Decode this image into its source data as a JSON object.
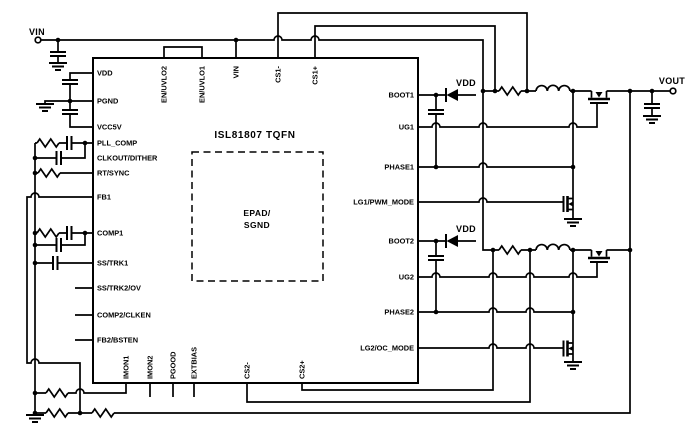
{
  "chip": {
    "title": "ISL81807 TQFN",
    "epad_line1": "EPAD/",
    "epad_line2": "SGND"
  },
  "pins": {
    "left": [
      "VDD",
      "PGND",
      "VCC5V",
      "PLL_COMP",
      "CLKOUT/DITHER",
      "RT/SYNC",
      "FB1",
      "COMP1",
      "SS/TRK1",
      "SS/TRK2/OV",
      "COMP2/CLKEN",
      "FB2/BSTEN"
    ],
    "top": [
      "EN/UVLO2",
      "EN/UVLO1",
      "VIN",
      "CS1-",
      "CS1+"
    ],
    "right": [
      "BOOT1",
      "UG1",
      "PHASE1",
      "LG1/PWM_MODE",
      "BOOT2",
      "UG2",
      "PHASE2",
      "LG2/OC_MODE"
    ],
    "bottom": [
      "IMON1",
      "IMON2",
      "PGOOD",
      "EXTBIAS",
      "CS2-",
      "CS2+"
    ]
  },
  "labels": {
    "vin": "VIN",
    "vout": "VOUT",
    "vdd_ch1": "VDD",
    "vdd_ch2": "VDD"
  },
  "colors": {
    "wire": "#000000",
    "background": "#ffffff"
  }
}
